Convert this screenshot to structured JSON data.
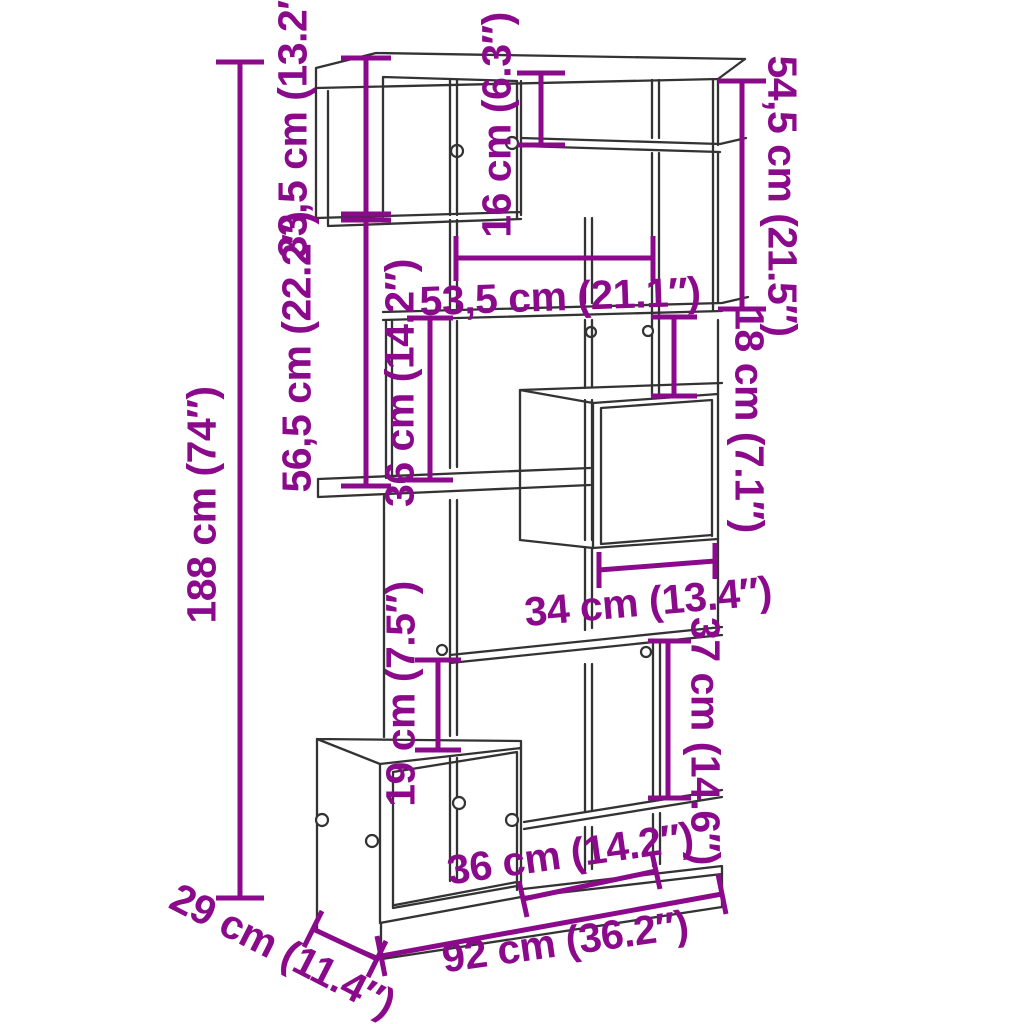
{
  "canvas": {
    "width": 1024,
    "height": 1024,
    "background": "#ffffff"
  },
  "style": {
    "dim_color": "#8B0A8B",
    "line_color": "#333333",
    "panel_fill": "#ffffff"
  },
  "dims": {
    "overall_height": {
      "label": "188 cm (74″)"
    },
    "top_cube_height": {
      "label": "33,5 cm (13.2″)"
    },
    "top_right_gap": {
      "label": "16 cm (6.3″)"
    },
    "right_upper_section": {
      "label": "54,5 cm (21.5″)"
    },
    "middle_opening_width": {
      "label": "53,5 cm (21.1″)"
    },
    "right_middle_gap": {
      "label": "18 cm (7.1″)"
    },
    "left_middle_section": {
      "label": "56,5 cm (22.2″)"
    },
    "left_middle_gap": {
      "label": "36 cm (14.2″)"
    },
    "middle_cube_width": {
      "label": "34 cm (13.4″)"
    },
    "right_lower_gap": {
      "label": "37 cm (14.6″)"
    },
    "left_lower_gap": {
      "label": "19 cm (7.5″)"
    },
    "base_opening_width": {
      "label": "36 cm (14.2″)"
    },
    "overall_width": {
      "label": "92 cm (36.2″)"
    },
    "overall_depth": {
      "label": "29 cm (11.4″)"
    }
  }
}
